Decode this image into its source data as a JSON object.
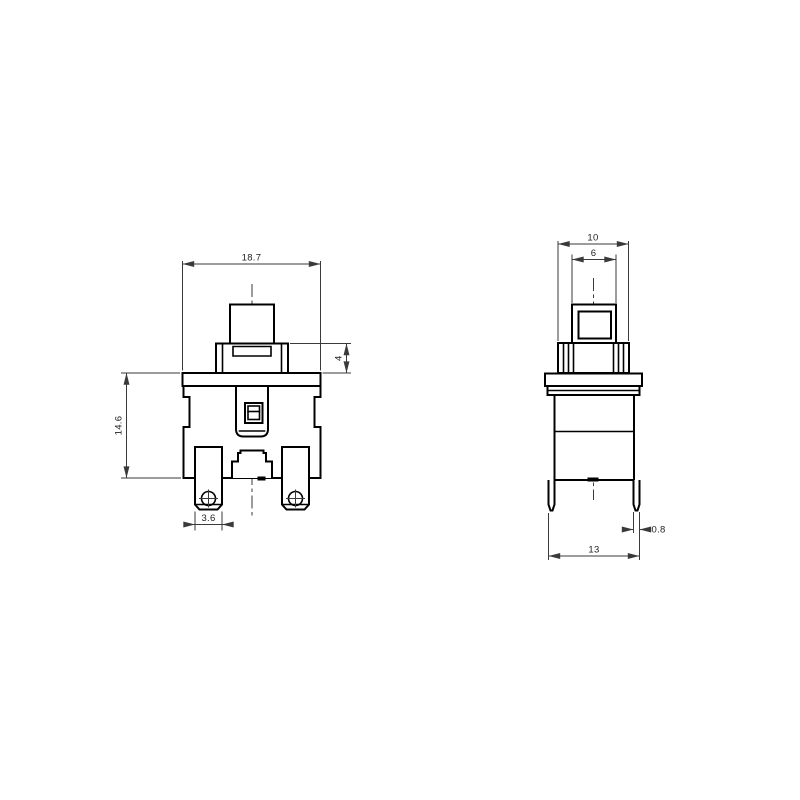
{
  "front": {
    "label": "front-view",
    "dims": {
      "overall_width": "18.7",
      "collar_height": "4",
      "body_height": "14.6",
      "terminal_width": "3.6"
    }
  },
  "side": {
    "label": "side-view",
    "dims": {
      "collar_width": "10",
      "button_width": "6",
      "pin_thickness": "0.8",
      "pin_span": "13"
    }
  },
  "colors": {
    "background": "#ffffff",
    "outline": "#000000",
    "dimension": "#3a3a3a"
  }
}
